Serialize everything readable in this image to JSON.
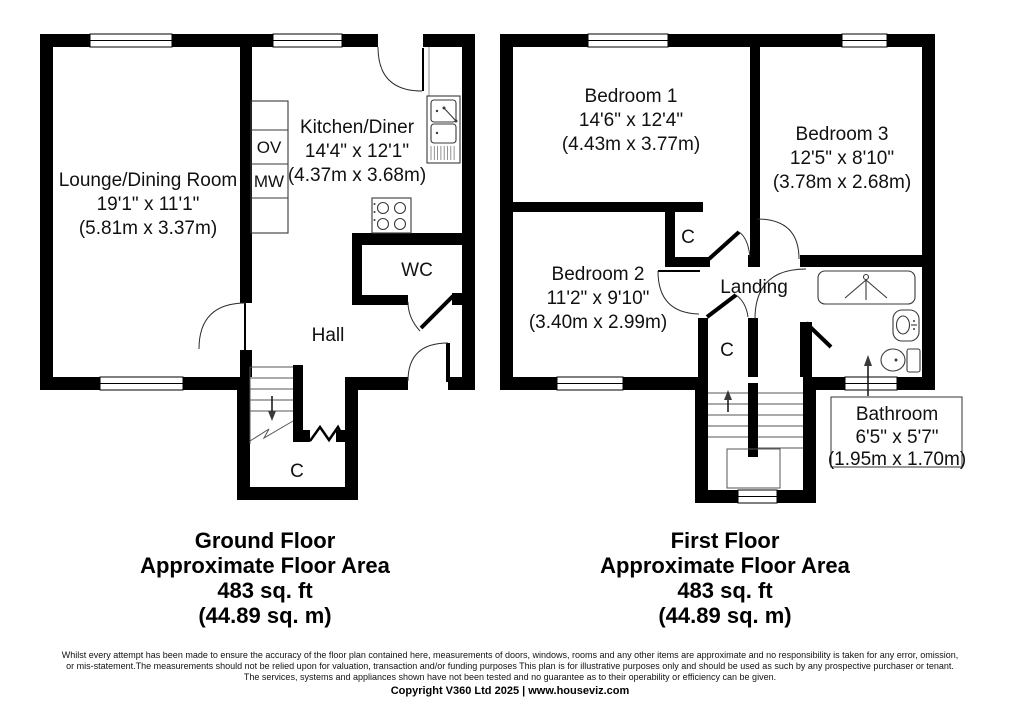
{
  "floors": [
    {
      "caption": {
        "title": "Ground Floor",
        "subtitle": "Approximate Floor Area",
        "area_imperial": "483 sq. ft",
        "area_metric": "(44.89 sq. m)"
      },
      "rooms": {
        "lounge": {
          "name": "Lounge/Dining Room",
          "dims_imperial": "19'1\" x 11'1\"",
          "dims_metric": "(5.81m x 3.37m)"
        },
        "kitchen": {
          "name": "Kitchen/Diner",
          "dims_imperial": "14'4\" x 12'1\"",
          "dims_metric": "(4.37m x 3.68m)"
        },
        "wc": {
          "name": "WC"
        },
        "hall": {
          "name": "Hall"
        },
        "cupboard": {
          "name": "C"
        },
        "oven_label": "OV",
        "microwave_label": "MW"
      }
    },
    {
      "caption": {
        "title": "First Floor",
        "subtitle": "Approximate Floor Area",
        "area_imperial": "483 sq. ft",
        "area_metric": "(44.89 sq. m)"
      },
      "rooms": {
        "bedroom1": {
          "name": "Bedroom 1",
          "dims_imperial": "14'6\" x 12'4\"",
          "dims_metric": "(4.43m x 3.77m)"
        },
        "bedroom2": {
          "name": "Bedroom 2",
          "dims_imperial": "11'2\" x 9'10\"",
          "dims_metric": "(3.40m x 2.99m)"
        },
        "bedroom3": {
          "name": "Bedroom 3",
          "dims_imperial": "12'5\" x 8'10\"",
          "dims_metric": "(3.78m x 2.68m)"
        },
        "landing": {
          "name": "Landing"
        },
        "bathroom": {
          "name": "Bathroom",
          "dims_imperial": "6'5\" x 5'7\"",
          "dims_metric": "(1.95m x 1.70m)"
        },
        "cupboard_upper": {
          "name": "C"
        },
        "cupboard_lower": {
          "name": "C"
        }
      }
    }
  ],
  "footer": {
    "disclaimer_lines": [
      "Whilst every attempt has been made to ensure the accuracy of the floor plan contained here, measurements of doors, windows, rooms and any other items are approximate and no responsibility is taken for any error, omission,",
      "or mis-statement.The measurements should not be relied upon for valuation, transaction and/or funding purposes This plan is for illustrative purposes only and should be used as such by any prospective purchaser or tenant.",
      "The services, systems and appliances shown have not been tested and no guarantee as to their operability or efficiency can be given."
    ],
    "copyright": "Copyright V360 Ltd 2025 | www.houseviz.com"
  },
  "colors": {
    "wall": "#000000",
    "background": "#ffffff",
    "text": "#111111"
  }
}
